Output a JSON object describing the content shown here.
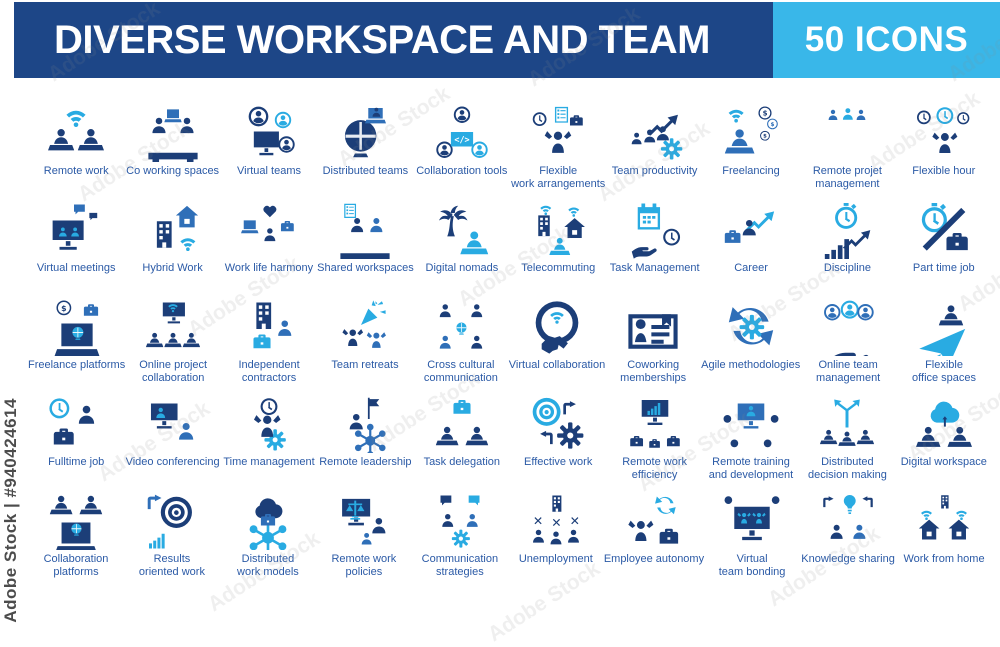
{
  "palette": {
    "header_bg": "#1d4687",
    "badge_bg": "#39b7e9",
    "icon_navy": "#1c3e78",
    "icon_blue": "#2f6fb8",
    "icon_cyan": "#29abe2",
    "label_text": "#2b5aa6",
    "header_text": "#ffffff"
  },
  "header": {
    "title": "DIVERSE WORKSPACE AND TEAM",
    "badge": "50 ICONS"
  },
  "watermark": {
    "id_text": "Adobe Stock | #940424614",
    "tile_text": "Adobe Stock"
  },
  "grid": {
    "rows": [
      [
        {
          "label": "Remote work",
          "icon": "remote-work"
        },
        {
          "label": "Co working spaces",
          "icon": "co-working-spaces"
        },
        {
          "label": "Virtual teams",
          "icon": "virtual-teams"
        },
        {
          "label": "Distributed teams",
          "icon": "distributed-teams"
        },
        {
          "label": "Collaboration tools",
          "icon": "collaboration-tools"
        },
        {
          "label": "Flexible\nwork arrangements",
          "icon": "flexible-work-arrangements"
        },
        {
          "label": "Team productivity",
          "icon": "team-productivity"
        },
        {
          "label": "Freelancing",
          "icon": "freelancing"
        },
        {
          "label": "Remote projet\nmanagement",
          "icon": "remote-project-management"
        },
        {
          "label": "Flexible hour",
          "icon": "flexible-hour"
        }
      ],
      [
        {
          "label": "Virtual meetings",
          "icon": "virtual-meetings"
        },
        {
          "label": "Hybrid Work",
          "icon": "hybrid-work"
        },
        {
          "label": "Work life harmony",
          "icon": "work-life-harmony"
        },
        {
          "label": "Shared workspaces",
          "icon": "shared-workspaces"
        },
        {
          "label": "Digital nomads",
          "icon": "digital-nomads"
        },
        {
          "label": "Telecommuting",
          "icon": "telecommuting"
        },
        {
          "label": "Task Management",
          "icon": "task-management"
        },
        {
          "label": "Career",
          "icon": "career"
        },
        {
          "label": "Discipline",
          "icon": "discipline"
        },
        {
          "label": "Part time job",
          "icon": "part-time-job"
        }
      ],
      [
        {
          "label": "Freelance platforms",
          "icon": "freelance-platforms"
        },
        {
          "label": "Online project\ncollaboration",
          "icon": "online-project-collaboration"
        },
        {
          "label": "Independent\ncontractors",
          "icon": "independent-contractors"
        },
        {
          "label": "Team retreats",
          "icon": "team-retreats"
        },
        {
          "label": "Cross cultural\ncommunication",
          "icon": "cross-cultural-communication"
        },
        {
          "label": "Virtual collaboration",
          "icon": "virtual-collaboration"
        },
        {
          "label": "Coworking\nmemberships",
          "icon": "coworking-memberships"
        },
        {
          "label": "Agile methodologies",
          "icon": "agile-methodologies"
        },
        {
          "label": "Online team\nmanagement",
          "icon": "online-team-management"
        },
        {
          "label": "Flexible\noffice spaces",
          "icon": "flexible-office-spaces"
        }
      ],
      [
        {
          "label": "Fulltime job",
          "icon": "fulltime-job"
        },
        {
          "label": "Video conferencing",
          "icon": "video-conferencing"
        },
        {
          "label": "Time management",
          "icon": "time-management"
        },
        {
          "label": "Remote leadership",
          "icon": "remote-leadership"
        },
        {
          "label": "Task delegation",
          "icon": "task-delegation"
        },
        {
          "label": "Effective work",
          "icon": "effective-work"
        },
        {
          "label": "Remote work\nefficiency",
          "icon": "remote-work-efficiency"
        },
        {
          "label": "Remote training\nand development",
          "icon": "remote-training-development"
        },
        {
          "label": "Distributed\ndecision making",
          "icon": "distributed-decision-making"
        },
        {
          "label": "Digital workspace",
          "icon": "digital-workspace"
        }
      ],
      [
        {
          "label": "Collaboration\nplatforms",
          "icon": "collaboration-platforms"
        },
        {
          "label": "Results\noriented work",
          "icon": "results-oriented-work"
        },
        {
          "label": "Distributed\nwork models",
          "icon": "distributed-work-models"
        },
        {
          "label": "Remote work\npolicies",
          "icon": "remote-work-policies"
        },
        {
          "label": "Communication\nstrategies",
          "icon": "communication-strategies"
        },
        {
          "label": "Unemployment",
          "icon": "unemployment"
        },
        {
          "label": "Employee autonomy",
          "icon": "employee-autonomy"
        },
        {
          "label": "Virtual\nteam bonding",
          "icon": "virtual-team-bonding"
        },
        {
          "label": "Knowledge sharing",
          "icon": "knowledge-sharing"
        },
        {
          "label": "Work from home",
          "icon": "work-from-home"
        }
      ]
    ]
  }
}
